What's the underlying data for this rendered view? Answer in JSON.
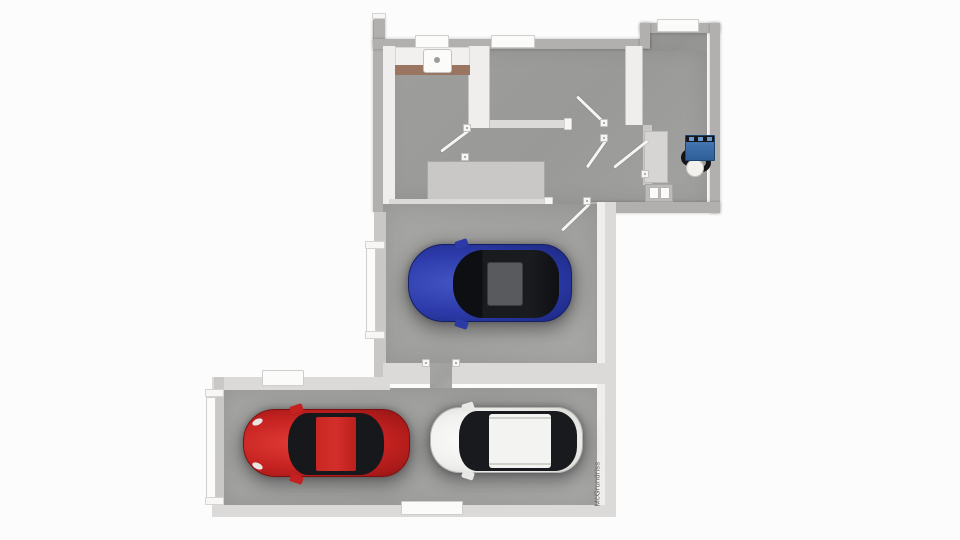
{
  "watermark": {
    "text": "McGrundriss"
  },
  "floorplan": {
    "type": "3d-top-down-floor-plan",
    "staircase": {
      "steps": 11
    },
    "cars": [
      {
        "name": "blue-car",
        "body_color": "#2b3aa8",
        "location": "single-garage"
      },
      {
        "name": "red-car",
        "body_color": "#c42220",
        "location": "double-garage"
      },
      {
        "name": "white-car",
        "body_color": "#f0f0ee",
        "location": "double-garage"
      }
    ],
    "fixtures": [
      {
        "name": "kitchen-counter-with-sink"
      },
      {
        "name": "staircase"
      },
      {
        "name": "boiler-unit",
        "color": "#3a6fae"
      },
      {
        "name": "water-tank"
      },
      {
        "name": "meter-box"
      }
    ],
    "palette": {
      "background": "#fcfcfc",
      "floor": "#9e9e9c",
      "garage_floor": "#a5a5a3",
      "exterior_wall": "#b2b0ae",
      "interior_wall": "#efeeec",
      "window": "#fbfbf9",
      "counter_edge": "#9a7562"
    }
  }
}
